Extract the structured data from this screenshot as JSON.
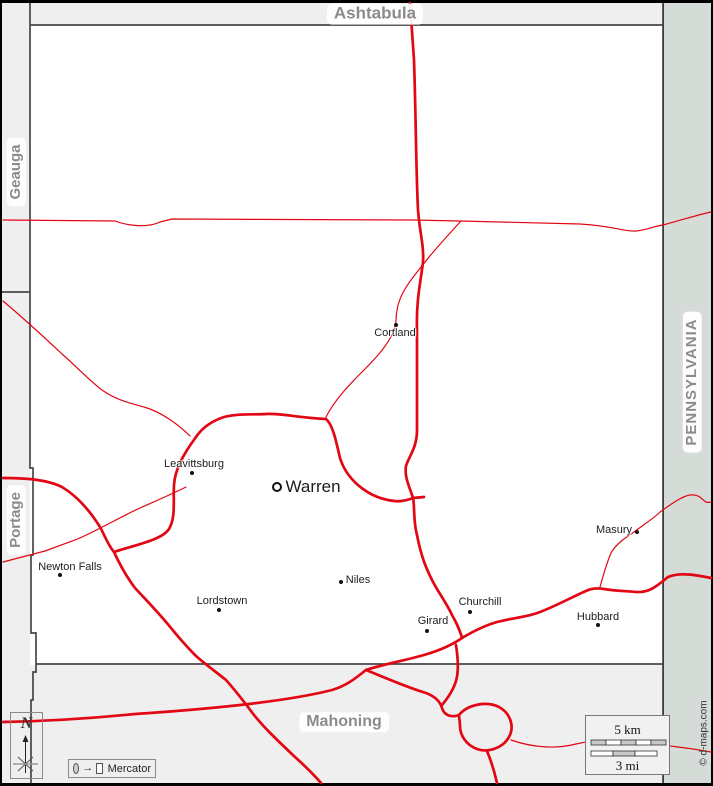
{
  "map_title": "Trumbull county area road map",
  "neighbors": {
    "north": "Ashtabula",
    "northwest": "Geauga",
    "southwest": "Portage",
    "south": "Mahoning",
    "east": "PENNSYLVANIA"
  },
  "cities": [
    {
      "name": "Cortland",
      "marker": "dot"
    },
    {
      "name": "Leavittsburg",
      "marker": "dot"
    },
    {
      "name": "Warren",
      "marker": "ring"
    },
    {
      "name": "Newton Falls",
      "marker": "dot"
    },
    {
      "name": "Lordstown",
      "marker": "dot"
    },
    {
      "name": "Niles",
      "marker": "dot"
    },
    {
      "name": "Girard",
      "marker": "dot"
    },
    {
      "name": "Churchill",
      "marker": "dot"
    },
    {
      "name": "Hubbard",
      "marker": "dot"
    },
    {
      "name": "Masury",
      "marker": "dot"
    }
  ],
  "north_arrow": {
    "label": "N"
  },
  "projection_legend": {
    "label": "Mercator"
  },
  "scale_bar": {
    "km_label": "5 km",
    "mi_label": "3 mi"
  },
  "credit": "© d-maps.com",
  "colors": {
    "road_red": "#e30613",
    "county_border": "#474747",
    "neighbor_fill": "#efefef",
    "pennsylvania_fill": "#d5dcd8",
    "map_fill": "#ffffff",
    "label_gray": "#8b8b8b"
  }
}
